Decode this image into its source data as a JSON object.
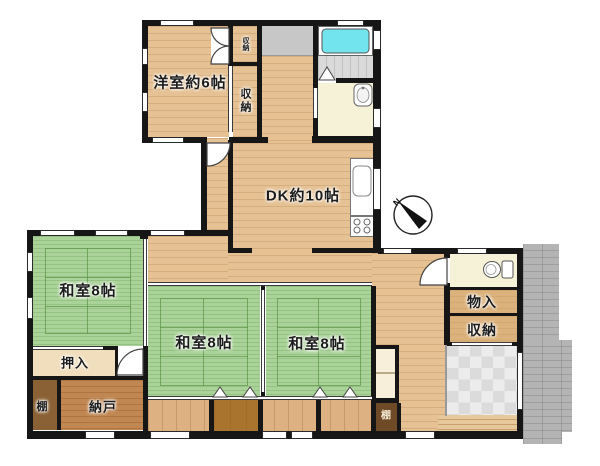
{
  "plan": {
    "title": "floor-plan",
    "rooms": {
      "yoshitsu": {
        "label": "洋室約6帖"
      },
      "dk": {
        "label": "DK約10帖"
      },
      "washitsu1": {
        "label": "和室8帖"
      },
      "washitsu2": {
        "label": "和室8帖"
      },
      "washitsu3": {
        "label": "和室8帖"
      },
      "oshiire": {
        "label": "押入"
      },
      "nando": {
        "label": "納戸"
      },
      "tana_left": {
        "label": "棚"
      },
      "tana_right": {
        "label": "棚"
      },
      "monoire": {
        "label": "物入"
      },
      "shuno_right": {
        "label": "収納"
      },
      "shuno_small": {
        "label": "収納"
      },
      "shuno_big": {
        "label": "収納"
      }
    },
    "compass": {
      "north_label": "N"
    },
    "colors": {
      "wall": "#161616",
      "tatami_green": "#aad399",
      "wood_floor": "#e5c193",
      "closet_tan": "#dcb27c",
      "shelf_dark_brown": "#6f4a26",
      "nando_wood": "#c08752",
      "bathtub_cyan": "#72e4ee",
      "pale_room": "#f6f2d8",
      "laundry_gray": "#c7c7c7",
      "terrace_gray": "#b4b4b4",
      "genkan_tile": "#ececec"
    }
  }
}
